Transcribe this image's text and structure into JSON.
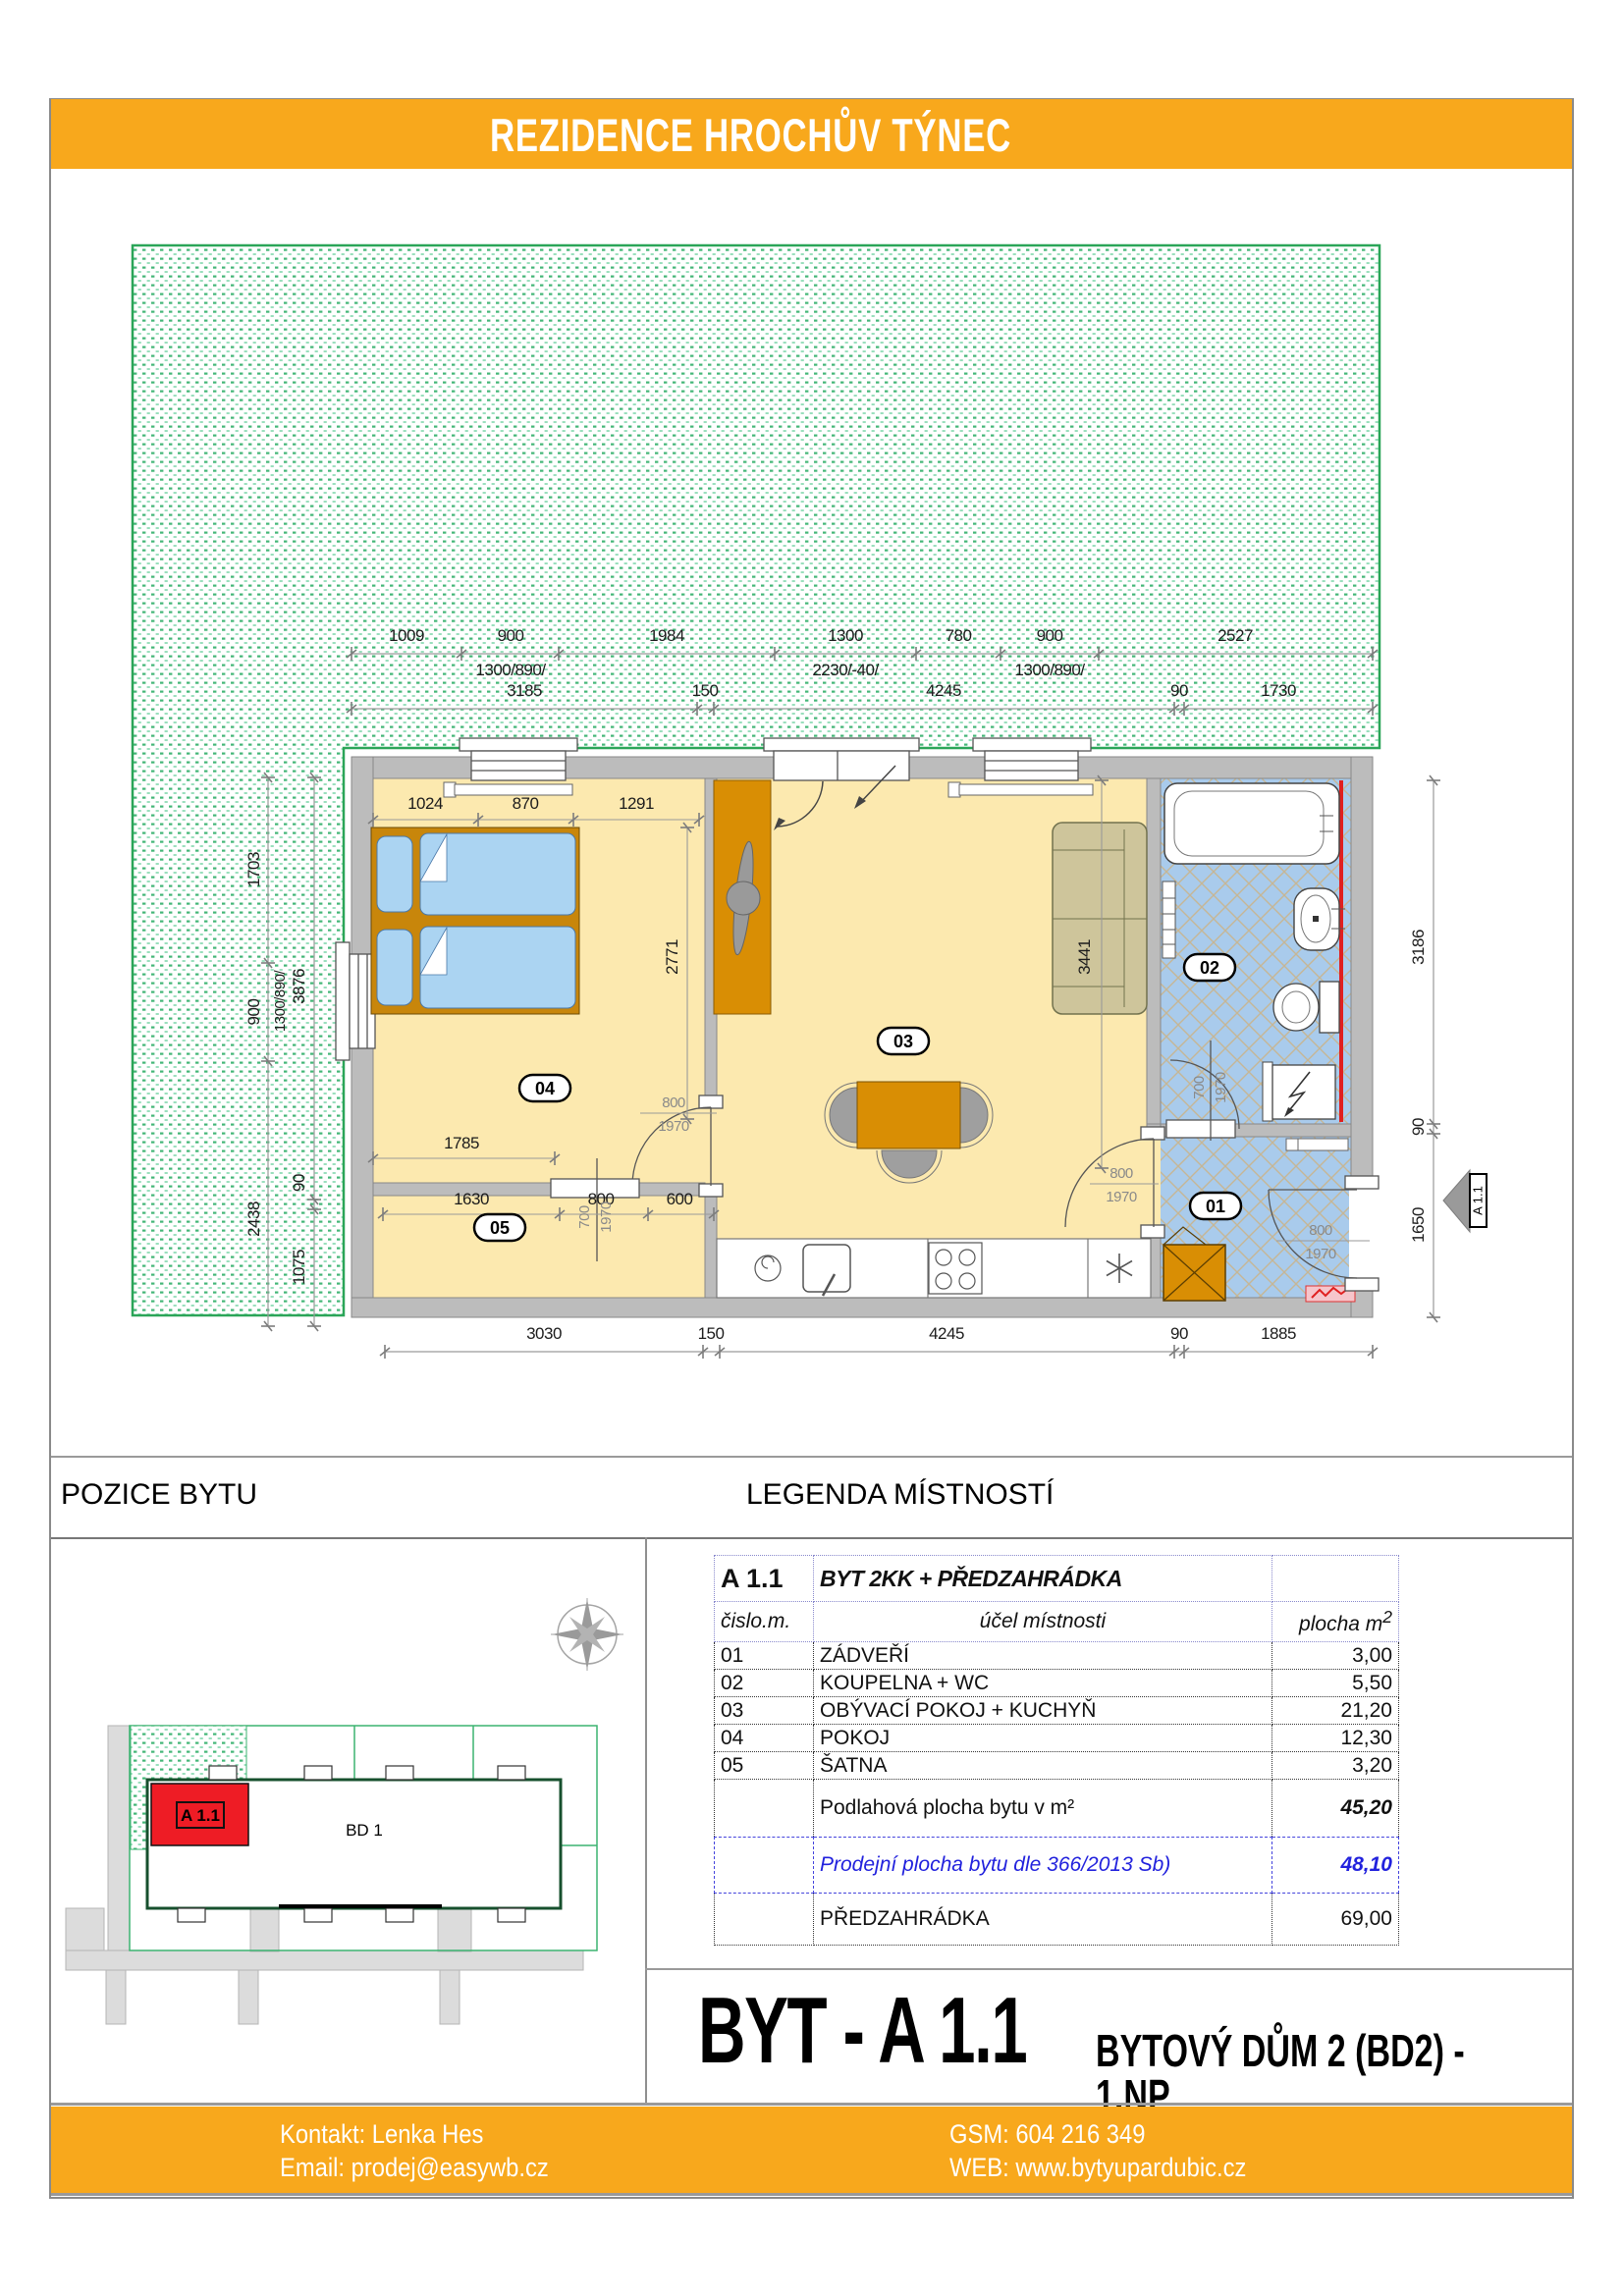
{
  "header": {
    "title": "REZIDENCE HROCHŮV TÝNEC",
    "accent_color": "#F8A81C"
  },
  "sections": {
    "position_title": "POZICE BYTU",
    "legend_title": "LEGENDA MÍSTNOSTÍ"
  },
  "unit": {
    "big_title": "BYT - A 1.1",
    "building_line": "BYTOVÝ DŮM 2 (BD2)  -  1.NP"
  },
  "site": {
    "building_label": "BD 1",
    "unit_label": "A 1.1"
  },
  "legend_table": {
    "unit_code": "A 1.1",
    "unit_type": "BYT 2KK + PŘEDZAHRÁDKA",
    "col_number": "čislo.m.",
    "col_purpose": "účel místnosti",
    "col_area": "plocha m",
    "col_area_sup": "2",
    "rows": [
      {
        "num": "01",
        "name": "ZÁDVEŘÍ",
        "area": "3,00"
      },
      {
        "num": "02",
        "name": "KOUPELNA + WC",
        "area": "5,50"
      },
      {
        "num": "03",
        "name": "OBÝVACÍ POKOJ + KUCHYŇ",
        "area": "21,20"
      },
      {
        "num": "04",
        "name": "POKOJ",
        "area": "12,30"
      },
      {
        "num": "05",
        "name": "ŠATNA",
        "area": "3,20"
      }
    ],
    "summary": [
      {
        "name": "Podlahová plocha bytu v m²",
        "area": "45,20"
      },
      {
        "name": "Prodejní plocha bytu dle 366/2013 Sb)",
        "area": "48,10"
      },
      {
        "name": "PŘEDZAHRÁDKA",
        "area": "69,00"
      }
    ]
  },
  "footer": {
    "contact": "Kontakt: Lenka Hes",
    "email": "Email: prodej@easywb.cz",
    "gsm": "GSM: 604 216 349",
    "web": "WEB: www.bytyupardubic.cz"
  },
  "plan": {
    "colors": {
      "garden_green": "#2FAE68",
      "tile_blue": "#A9CBEC",
      "floor_yellow": "#FCE9AF",
      "furniture_orange": "#D98E04",
      "unit_red": "#EE1C25"
    },
    "top_row1": [
      "1009",
      "900",
      "1984",
      "1300",
      "780",
      "900",
      "2527"
    ],
    "top_row1_sub": [
      "1300/890/",
      "2230/-40/",
      "1300/890/"
    ],
    "top_row2": [
      "3185",
      "150",
      "4245",
      "90",
      "1730"
    ],
    "bottom_row": [
      "3030",
      "150",
      "4245",
      "90",
      "1885"
    ],
    "left_col_a": [
      "1703",
      "900",
      "2438"
    ],
    "left_col_a_sub": "1300/890/",
    "left_col_b": [
      "3876",
      "90",
      "1075"
    ],
    "right_col": [
      "3186",
      "90",
      "1650"
    ],
    "bed_dims": [
      "1024",
      "870",
      "1291"
    ],
    "bed_depth": "2771",
    "pokoj_width": "1785",
    "satna_dims": [
      "1630",
      "800",
      "600"
    ],
    "sofa_dim": "3441",
    "door_04": [
      "800",
      "1970"
    ],
    "door_05": [
      "700",
      "1970"
    ],
    "door_02": [
      "700",
      "1970"
    ],
    "door_03": [
      "800",
      "1970"
    ],
    "door_01": [
      "800",
      "1970"
    ],
    "rooms": [
      "01",
      "02",
      "03",
      "04",
      "05"
    ],
    "unit_marker": "A 1.1"
  }
}
